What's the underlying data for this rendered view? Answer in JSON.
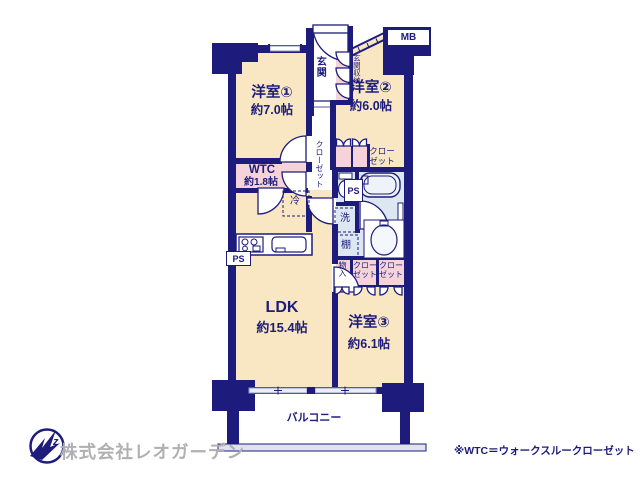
{
  "plan": {
    "rooms": {
      "y1": {
        "name": "洋室①",
        "size": "約7.0帖"
      },
      "y2": {
        "name": "洋室②",
        "size": "約6.0帖"
      },
      "y3": {
        "name": "洋室③",
        "size": "約6.1帖"
      },
      "ldk": {
        "name": "LDK",
        "size": "約15.4帖"
      },
      "wtc": {
        "name": "WTC",
        "size": "約1.8帖"
      },
      "genkan": "玄関",
      "genkan_shuno": "玄関収納",
      "balcony": "バルコニー"
    },
    "labels": {
      "closet_hall": "クローゼット",
      "closet_y2": "クローゼット",
      "closet_y3a": "クローゼット",
      "closet_y3b": "クローゼット",
      "mono_ire": "物入",
      "rei": "冷",
      "sen": "洗",
      "tana": "棚",
      "mb": "MB",
      "ps_left": "PS",
      "ps_toilet": "PS"
    },
    "colors": {
      "wall_navy": "#1d1c7c",
      "room_cream": "#f8e7c2",
      "closet_pink": "#f5d3d8",
      "wet_blue": "#dde7f1",
      "logo_gray": "#b0b0b3"
    }
  },
  "footer": {
    "company": "株式会社レオガーデン",
    "note": "※WTC＝ウォークスルークローゼット",
    "logo_mark": "z"
  }
}
